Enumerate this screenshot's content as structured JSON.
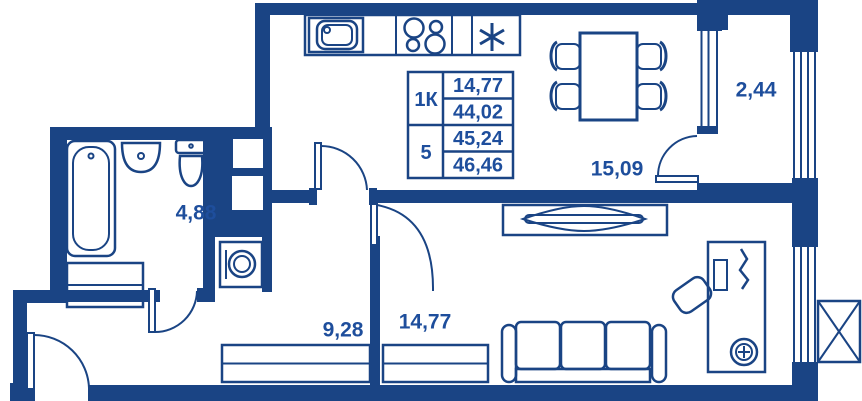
{
  "colors": {
    "wall": "#1a4484",
    "text": "#1e4e9c",
    "bg": "#ffffff"
  },
  "stamp_table": {
    "rows": [
      {
        "type": "1К",
        "area_top": "14,77",
        "area_bottom": "44,02"
      },
      {
        "type": "5",
        "area_top": "45,24",
        "area_bottom": "46,46"
      }
    ]
  },
  "rooms": {
    "kitchen": {
      "area": "15,09"
    },
    "balcony": {
      "area": "2,44"
    },
    "bathroom": {
      "area": "4,88"
    },
    "hallway": {
      "area": "9,28"
    },
    "living_room": {
      "area": "14,77"
    }
  },
  "symbols": {
    "fridge_marker": "✳"
  }
}
